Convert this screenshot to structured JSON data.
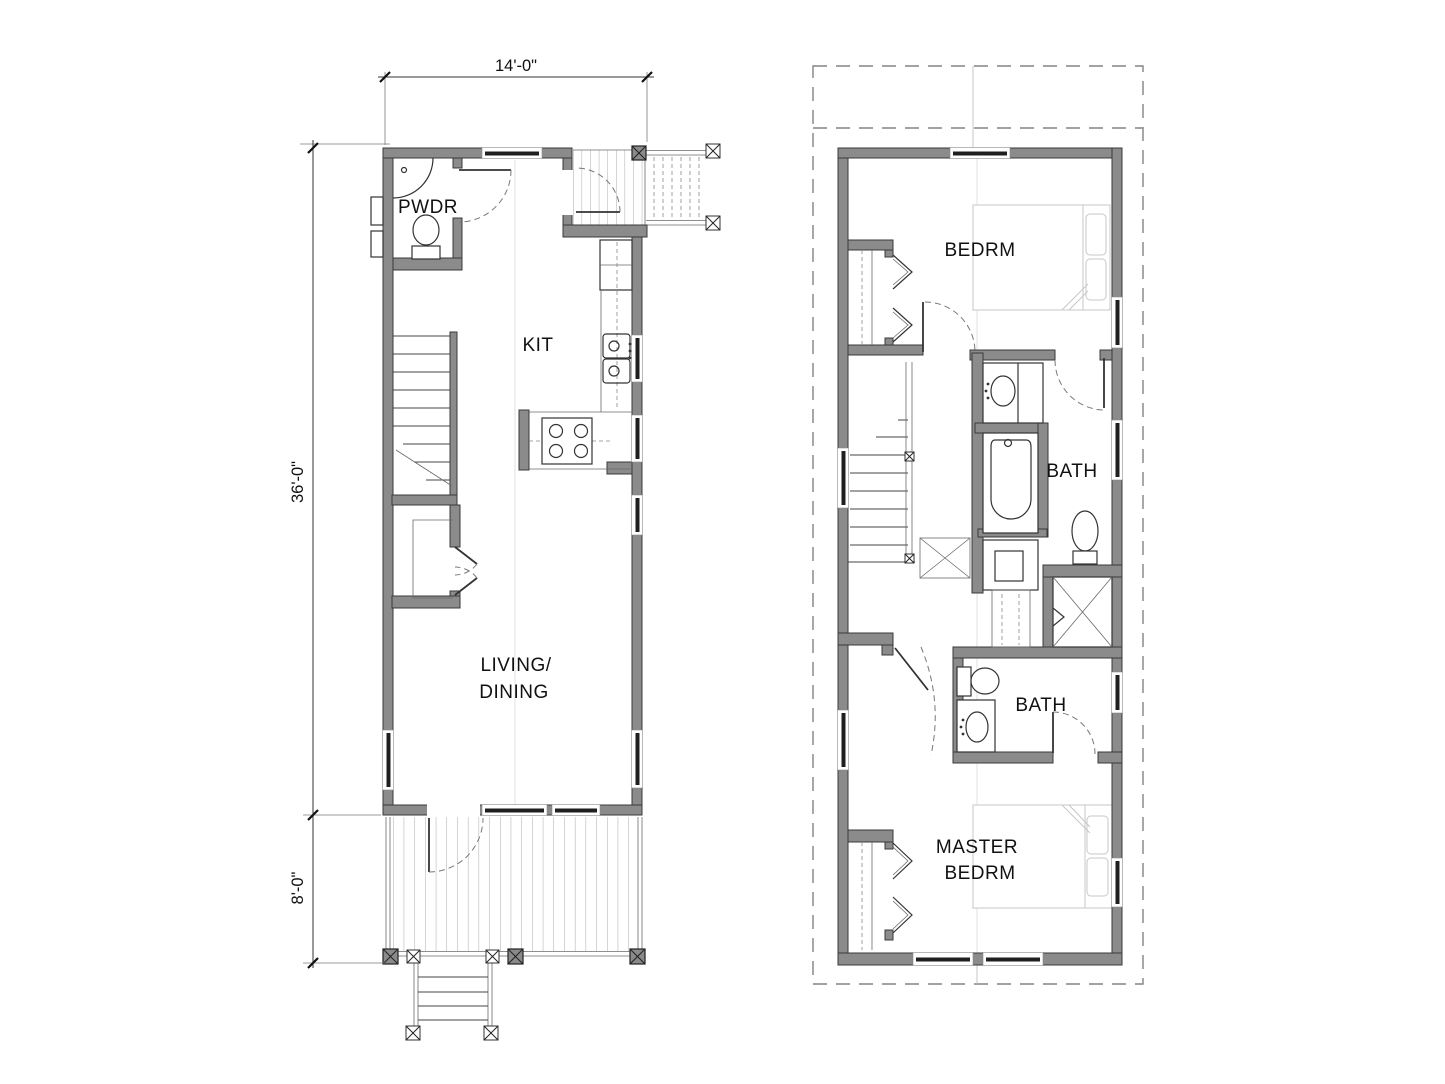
{
  "first_floor": {
    "dimensions": {
      "width": "14'-0\"",
      "body_depth": "36'-0\"",
      "porch_depth": "8'-0\""
    },
    "rooms": {
      "powder": "PWDR",
      "kitchen": "KIT",
      "living_dining": {
        "line1": "LIVING/",
        "line2": "DINING"
      }
    }
  },
  "second_floor": {
    "rooms": {
      "bedroom": "BEDRM",
      "bath_upper": "BATH",
      "bath_lower": "BATH",
      "master_bedroom": {
        "line1": "MASTER",
        "line2": "BEDRM"
      }
    }
  },
  "colors": {
    "background": "#ffffff",
    "wall_fill": "#8b8b8b",
    "wall_stroke": "#3a3a3a",
    "window_glass": "#1f1f1f",
    "line": "#3c3c3c",
    "faint_furniture": "#c7c7c7",
    "roof_dash": "#838383"
  }
}
